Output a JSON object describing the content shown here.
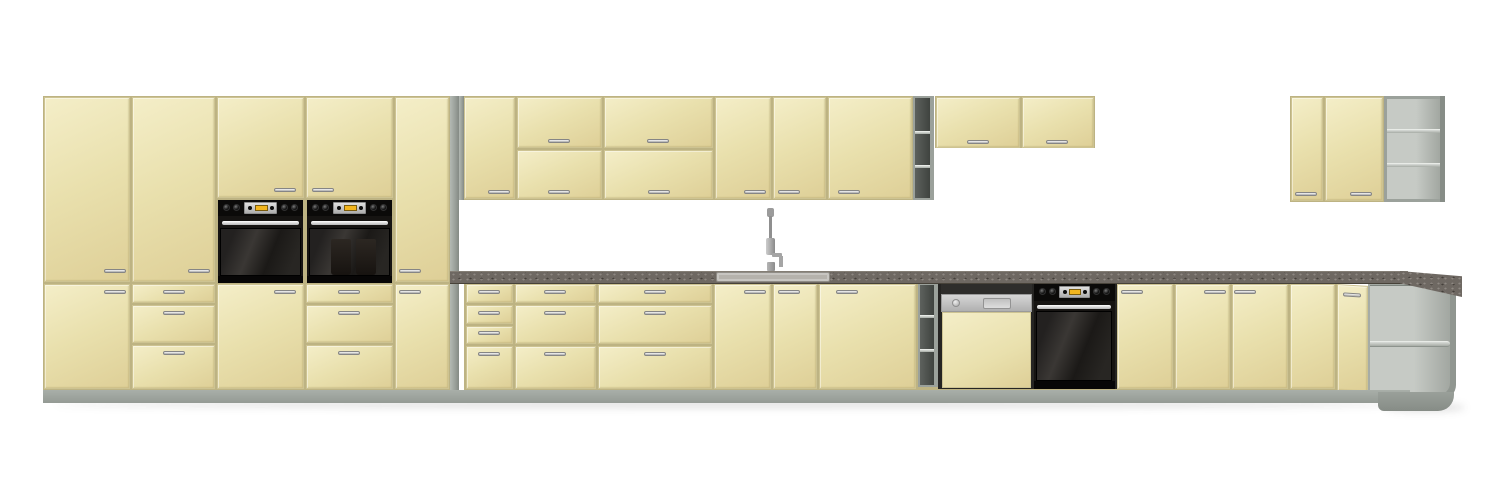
{
  "scene": {
    "type": "3d-product-render",
    "subject": "modular kitchen cabinet set with cream fronts, grey carcass, dark speckled worktop and built-in appliances",
    "background": "plain white",
    "visible_text": "none"
  },
  "colors": {
    "wall": "#ffffff",
    "front": "#e9e0ad",
    "front-hi": "#f4eec8",
    "front-lo": "#decf97",
    "gap-line": "#bdb383",
    "carcass": "#9ba19b",
    "plinth": "#a9afa9",
    "counter": "#6e6862",
    "counter-dark": "#474239",
    "appliance-black": "#161412",
    "panel-steel": "#e0e0e0",
    "display-amber": "#f2b51e",
    "sink-steel": "#b5b2ac"
  },
  "modules": {
    "tall_cabinet_columns": 5,
    "built_in_wall_ovens": 2,
    "mid_wall_cabinets": 6,
    "short_wall_cabinets": 2,
    "corner_wall_cabinet_doors": 2,
    "open_shelf_units": 4,
    "base_drawer_units": 3,
    "base_door_cabinets": 8,
    "sink_drainer": 1,
    "faucet": 1,
    "dishwasher_semi_integrated": 1,
    "built_in_under_counter_oven": 1,
    "corner_base_open_shelf": 1
  }
}
